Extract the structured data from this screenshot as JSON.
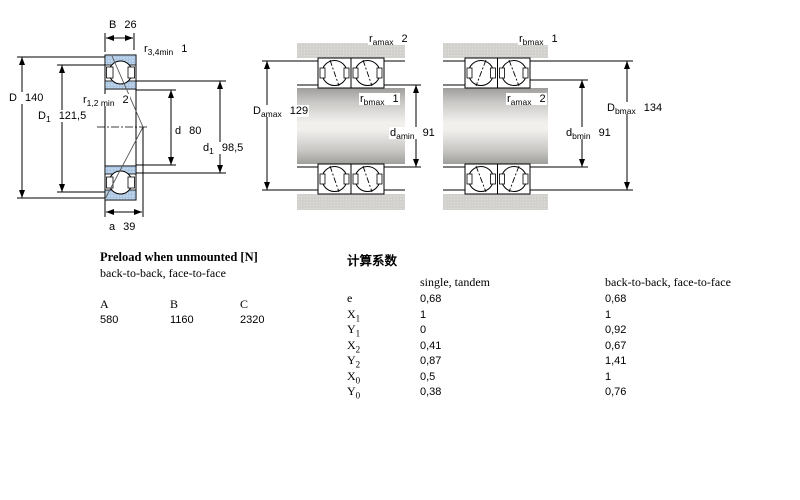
{
  "drawing": {
    "left": {
      "B": {
        "base": "B",
        "sub": "",
        "value": "26"
      },
      "r34": {
        "base": "r",
        "sub": "3,4min",
        "value": "1"
      },
      "D": {
        "base": "D",
        "sub": "",
        "value": "140"
      },
      "D1": {
        "base": "D",
        "sub": "1",
        "value": "121,5"
      },
      "r12": {
        "base": "r",
        "sub": "1,2 min",
        "value": "2"
      },
      "d": {
        "base": "d",
        "sub": "",
        "value": "80"
      },
      "d1": {
        "base": "d",
        "sub": "1",
        "value": "98,5"
      },
      "a": {
        "base": "a",
        "sub": "",
        "value": "39"
      }
    },
    "middle": {
      "ra": {
        "base": "r",
        "sub": "amax",
        "value": "2"
      },
      "rb": {
        "base": "r",
        "sub": "bmax",
        "value": "1"
      },
      "Da": {
        "base": "D",
        "sub": "amax",
        "value": "129"
      },
      "da": {
        "base": "d",
        "sub": "amin",
        "value": "91"
      }
    },
    "right": {
      "rb": {
        "base": "r",
        "sub": "bmax",
        "value": "1"
      },
      "ra": {
        "base": "r",
        "sub": "amax",
        "value": "2"
      },
      "Db": {
        "base": "D",
        "sub": "bmax",
        "value": "134"
      },
      "db": {
        "base": "d",
        "sub": "bmin",
        "value": "91"
      }
    }
  },
  "preload": {
    "title": "Preload when unmounted [N]",
    "subtitle": "back-to-back, face-to-face",
    "columns": [
      "A",
      "B",
      "C"
    ],
    "values": [
      "580",
      "1160",
      "2320"
    ]
  },
  "factors": {
    "title": "计算系数",
    "col1": "single, tandem",
    "col2": "back-to-back, face-to-face",
    "rows": [
      {
        "base": "e",
        "sub": "",
        "v1": "0,68",
        "v2": "0,68"
      },
      {
        "base": "X",
        "sub": "1",
        "v1": "1",
        "v2": "1"
      },
      {
        "base": "Y",
        "sub": "1",
        "v1": "0",
        "v2": "0,92"
      },
      {
        "base": "X",
        "sub": "2",
        "v1": "0,41",
        "v2": "0,67"
      },
      {
        "base": "Y",
        "sub": "2",
        "v1": "0,87",
        "v2": "1,41"
      },
      {
        "base": "X",
        "sub": "0",
        "v1": "0,5",
        "v2": "1"
      },
      {
        "base": "Y",
        "sub": "0",
        "v1": "0,38",
        "v2": "0,76"
      }
    ]
  },
  "colors": {
    "ring_blue": "#aac6e3",
    "halftone_grey": "#d3d1ce",
    "line_black": "#000000"
  }
}
